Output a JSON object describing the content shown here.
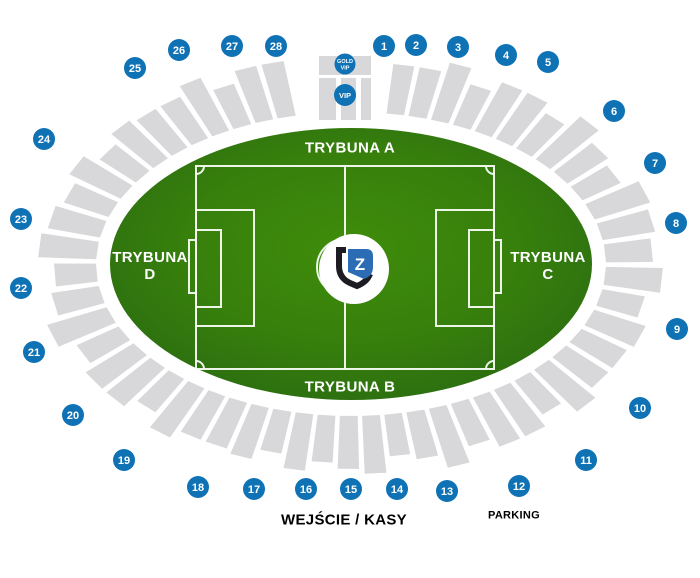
{
  "stands": {
    "a": "TRYBUNA A",
    "b": "TRYBUNA B",
    "c_line1": "TRYBUNA",
    "c_line2": "C",
    "d_line1": "TRYBUNA",
    "d_line2": "D"
  },
  "vip": {
    "gold_line1": "GOLD",
    "gold_line2": "VIP",
    "vip": "VIP"
  },
  "logo_letter": "Z",
  "footer": {
    "entrance": "WEJŚCIE / KASY",
    "parking": "PARKING"
  },
  "sections": [
    {
      "label": "1",
      "x": 384,
      "y": 46
    },
    {
      "label": "2",
      "x": 416,
      "y": 45
    },
    {
      "label": "3",
      "x": 458,
      "y": 47
    },
    {
      "label": "4",
      "x": 506,
      "y": 55
    },
    {
      "label": "5",
      "x": 548,
      "y": 62
    },
    {
      "label": "6",
      "x": 614,
      "y": 111
    },
    {
      "label": "7",
      "x": 655,
      "y": 163
    },
    {
      "label": "8",
      "x": 676,
      "y": 223
    },
    {
      "label": "9",
      "x": 677,
      "y": 329
    },
    {
      "label": "10",
      "x": 640,
      "y": 408
    },
    {
      "label": "11",
      "x": 586,
      "y": 460
    },
    {
      "label": "12",
      "x": 519,
      "y": 486
    },
    {
      "label": "13",
      "x": 447,
      "y": 491
    },
    {
      "label": "14",
      "x": 397,
      "y": 489
    },
    {
      "label": "15",
      "x": 351,
      "y": 489
    },
    {
      "label": "16",
      "x": 306,
      "y": 489
    },
    {
      "label": "17",
      "x": 254,
      "y": 489
    },
    {
      "label": "18",
      "x": 198,
      "y": 487
    },
    {
      "label": "19",
      "x": 124,
      "y": 460
    },
    {
      "label": "20",
      "x": 73,
      "y": 415
    },
    {
      "label": "21",
      "x": 34,
      "y": 352
    },
    {
      "label": "22",
      "x": 21,
      "y": 288
    },
    {
      "label": "23",
      "x": 21,
      "y": 219
    },
    {
      "label": "24",
      "x": 44,
      "y": 139
    },
    {
      "label": "25",
      "x": 135,
      "y": 68
    },
    {
      "label": "26",
      "x": 179,
      "y": 50
    },
    {
      "label": "27",
      "x": 232,
      "y": 46
    },
    {
      "label": "28",
      "x": 276,
      "y": 46
    }
  ],
  "colors": {
    "section_blue": "#0f72b5",
    "stand_gray": "#d8d8da",
    "field_center": "#3f8c0b",
    "field_mid": "#37800c",
    "field_edge": "#2b6c11",
    "pitch_line": "#f4faf0",
    "logo_black": "#1c1c22",
    "logo_blue": "#2b6cb5"
  }
}
